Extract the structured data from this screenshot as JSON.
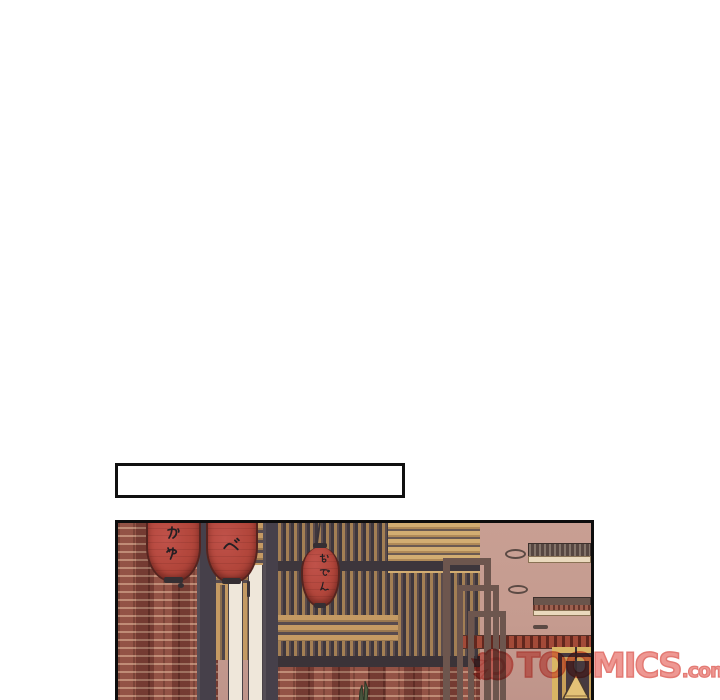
{
  "page": {
    "background_color": "#ffffff"
  },
  "caption_box": {
    "text": ""
  },
  "comic_panel": {
    "description": "japanese-izakaya-storefront",
    "lanterns": [
      {
        "label": "かや"
      },
      {
        "label": "べ"
      },
      {
        "label": "おでん"
      }
    ],
    "colors": {
      "lantern_red": "#b2463b",
      "brick_red": "#87453a",
      "wood_tan": "#c49a63",
      "wall_mauve": "#c59b8f",
      "post_gray": "#47414a",
      "frame_yellow": "#d9b564",
      "outline_black": "#0d0d0d"
    }
  },
  "watermark": {
    "brand": "TOOMICS",
    "suffix": ".com",
    "color": "#ee938d"
  }
}
